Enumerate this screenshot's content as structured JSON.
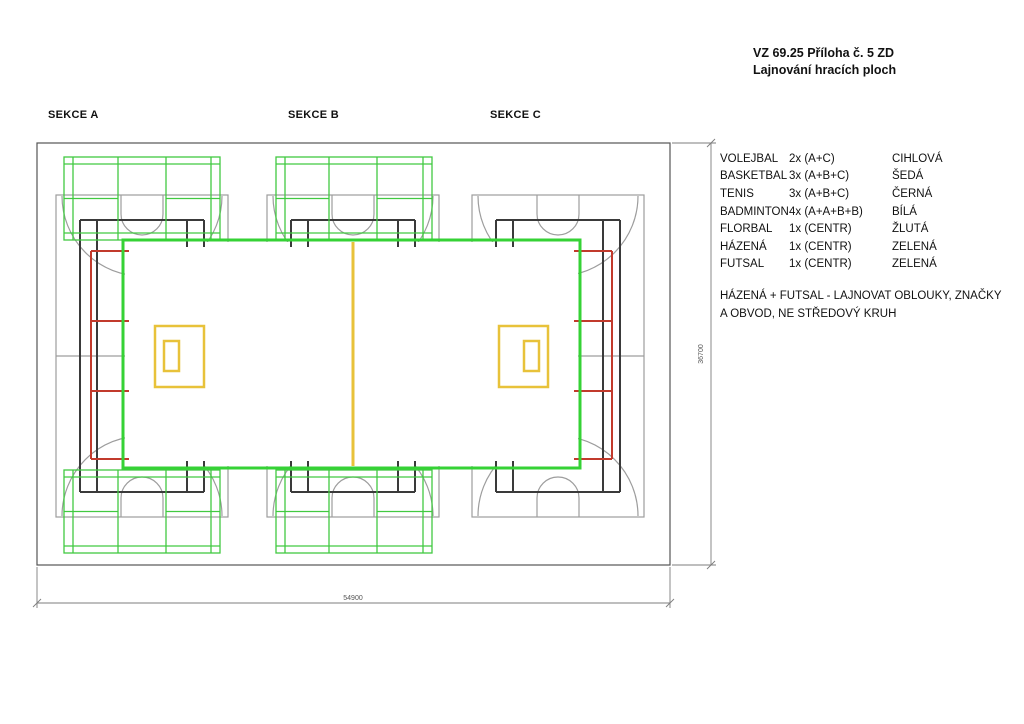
{
  "title": {
    "line1": "VZ 69.25 Příloha č. 5 ZD",
    "line2": "Lajnování hracích ploch"
  },
  "sections": [
    {
      "label": "SEKCE A"
    },
    {
      "label": "SEKCE B"
    },
    {
      "label": "SEKCE C"
    }
  ],
  "legend": {
    "rows": [
      {
        "sport": "VOLEJBAL",
        "count": "2x (A+C)",
        "color_name": "CIHLOVÁ"
      },
      {
        "sport": "BASKETBAL",
        "count": "3x (A+B+C)",
        "color_name": "ŠEDÁ"
      },
      {
        "sport": "TENIS",
        "count": "3x (A+B+C)",
        "color_name": "ČERNÁ"
      },
      {
        "sport": "BADMINTON",
        "count": "4x (A+A+B+B)",
        "color_name": "BÍLÁ"
      },
      {
        "sport": "FLORBAL",
        "count": "1x (CENTR)",
        "color_name": "ŽLUTÁ"
      },
      {
        "sport": "HÁZENÁ",
        "count": "1x (CENTR)",
        "color_name": "ZELENÁ"
      },
      {
        "sport": "FUTSAL",
        "count": "1x (CENTR)",
        "color_name": "ZELENÁ"
      }
    ]
  },
  "note": {
    "line1": "HÁZENÁ + FUTSAL - LAJNOVAT OBLOUKY, ZNAČKY",
    "line2": "A OBVOD, NE STŘEDOVÝ KRUH"
  },
  "dimensions": {
    "width_label": "54900",
    "height_label": "36700"
  },
  "colors": {
    "volleyball": "#c23a2c",
    "basketball": "#9d9d9d",
    "tennis": "#3a3a3a",
    "badminton": "#41c941",
    "handball": "#35d235",
    "floorball": "#e8c23a",
    "wall": "#555555",
    "dim": "#7d7d7d"
  }
}
